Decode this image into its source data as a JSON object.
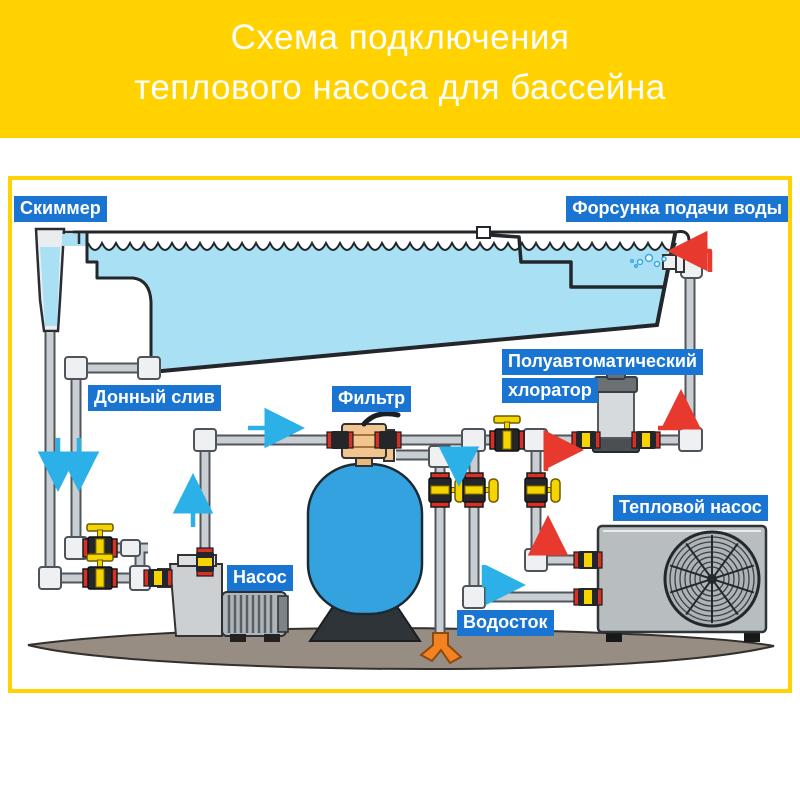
{
  "header": {
    "line1": "Схема подключения",
    "line2": "теплового насоса для бассейна"
  },
  "labels": {
    "skimmer": "Скиммер",
    "inlet_nozzle": "Форсунка подачи воды",
    "bottom_drain": "Донный слив",
    "filter": "Фильтр",
    "chlorinator_line1": "Полуавтоматический",
    "chlorinator_line2": "хлоратор",
    "pump": "Насос",
    "heat_pump": "Тепловой насос",
    "drain": "Водосток"
  },
  "colors": {
    "header_bg": "#ffd200",
    "frame_border": "#ffd200",
    "label_bg": "#1a75d2",
    "label_text": "#ffffff",
    "water": "#a9e0f4",
    "pipe": "#c9ced2",
    "pipe_outline": "#50565c",
    "valve_handle": "#f5d400",
    "union_red": "#d93025",
    "flow_cold_arrow": "#2bb1e8",
    "flow_hot_arrow": "#e8392e",
    "filter_tank": "#35a2e0",
    "filter_valve": "#f2c48f",
    "equipment_gray": "#b8bec0",
    "ground": "#978d83",
    "drain_splash": "#f58220"
  }
}
